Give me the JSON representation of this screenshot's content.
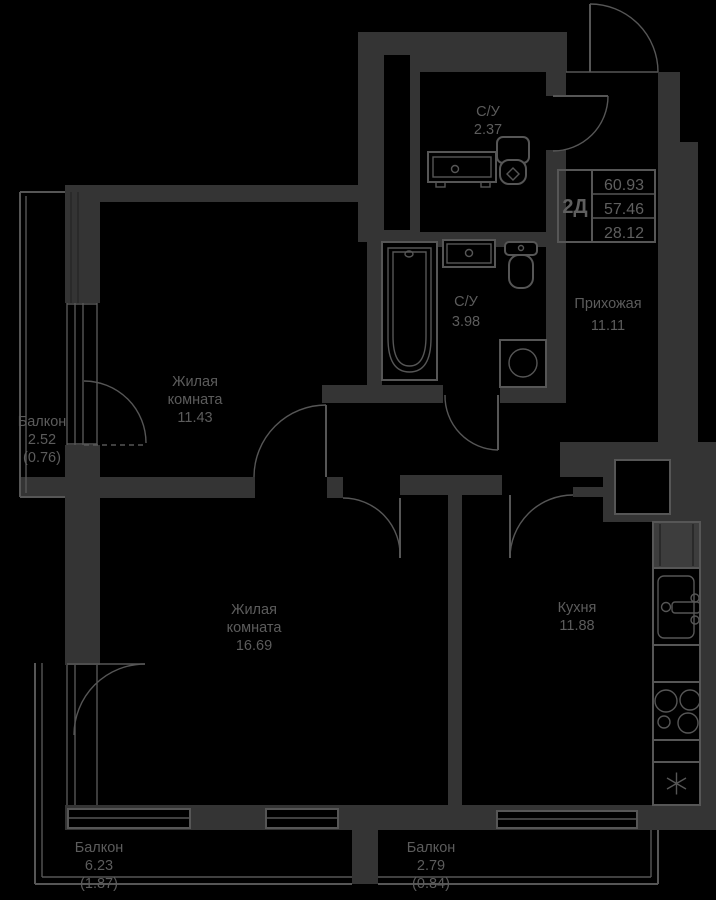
{
  "plan": {
    "type_label": "2Д",
    "area_values": [
      "60.93",
      "57.46",
      "28.12"
    ],
    "rooms": {
      "wc_small": {
        "name": "С/У",
        "area": "2.37"
      },
      "wc_big": {
        "name": "С/У",
        "area": "3.98"
      },
      "hallway": {
        "name": "Прихожая",
        "area": "11.11"
      },
      "living1": {
        "name_line1": "Жилая",
        "name_line2": "комната",
        "area": "11.43"
      },
      "living2": {
        "name_line1": "Жилая",
        "name_line2": "комната",
        "area": "16.69"
      },
      "kitchen": {
        "name": "Кухня",
        "area": "11.88"
      },
      "balcony_left": {
        "name": "Балкон",
        "area": "2.52",
        "area_reduced": "(0.76)"
      },
      "balcony_bottom_left": {
        "name": "Балкон",
        "area": "6.23",
        "area_reduced": "(1.87)"
      },
      "balcony_bottom_right": {
        "name": "Балкон",
        "area": "2.79",
        "area_reduced": "(0.84)"
      }
    },
    "colors": {
      "background": "#000000",
      "wall": "#343434",
      "line": "#565656",
      "text": "#5c5c5c"
    },
    "icons": {
      "fridge": "snowflake"
    }
  }
}
